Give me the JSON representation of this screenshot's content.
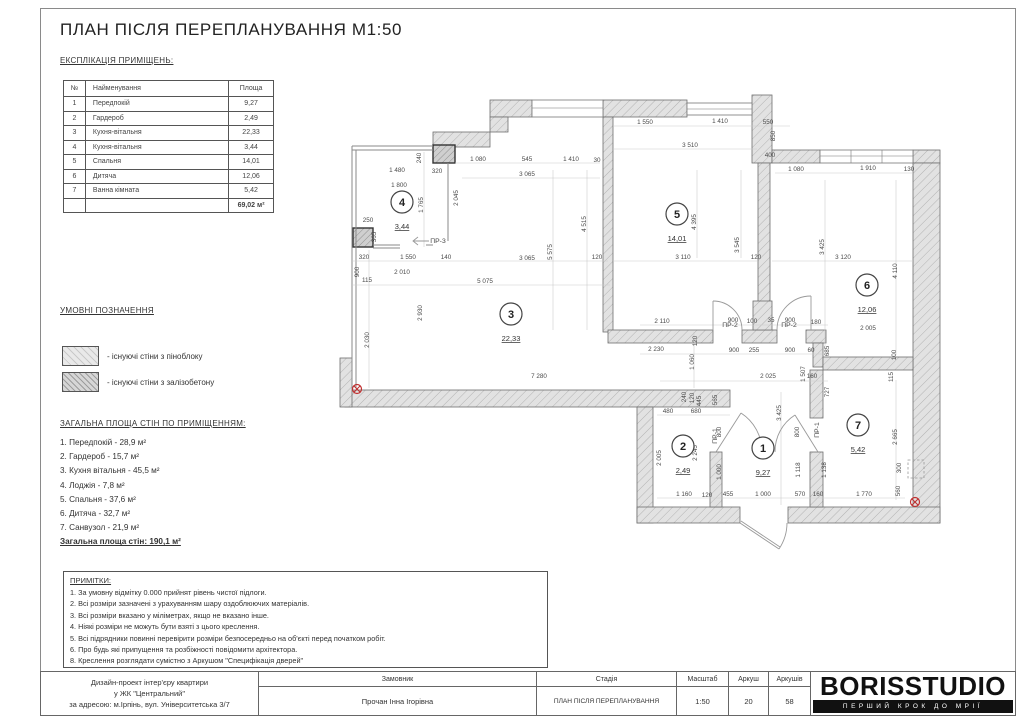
{
  "page": {
    "title": "ПЛАН ПІСЛЯ ПЕРЕПЛАНУВАННЯ М1:50"
  },
  "explication": {
    "heading": "ЕКСПЛІКАЦІЯ ПРИМІЩЕНЬ:",
    "columns": [
      "№",
      "Найменування",
      "Площа"
    ],
    "rows": [
      [
        "1",
        "Передпокій",
        "9,27"
      ],
      [
        "2",
        "Гардероб",
        "2,49"
      ],
      [
        "3",
        "Кухня-вітальня",
        "22,33"
      ],
      [
        "4",
        "Кухня-вітальня",
        "3,44"
      ],
      [
        "5",
        "Спальня",
        "14,01"
      ],
      [
        "6",
        "Дитяча",
        "12,06"
      ],
      [
        "7",
        "Ванна кімната",
        "5,42"
      ]
    ],
    "total": "69,02 м²"
  },
  "legend": {
    "heading": "УМОВНІ ПОЗНАЧЕННЯ",
    "items": [
      {
        "swatch": "foam-block",
        "label": "- існуючі стіни з піноблоку"
      },
      {
        "swatch": "reinforced-concrete",
        "label": "- існуючі стіни з залізобетону"
      }
    ]
  },
  "wall_areas": {
    "heading": "ЗАГАЛЬНА ПЛОЩА СТІН ПО ПРИМІЩЕННЯМ:",
    "items": [
      "1. Передпокій - 28,9 м²",
      "2. Гардероб - 15,7 м²",
      "3. Кухня вітальня - 45,5 м²",
      "4. Лоджія - 7,8 м²",
      "5. Спальня - 37,6 м²",
      "6. Дитяча - 32,7 м²",
      "7. Санвузол - 21,9 м²"
    ],
    "total": "Загальна площа стін: 190,1 м²"
  },
  "notes": {
    "heading": "ПРИМІТКИ:",
    "items": [
      "1. За умовну відмітку 0.000 прийнят рівень чистої підлоги.",
      "2. Всі розміри зазначені з урахуванням шару оздоблюючих матеріалів.",
      "3. Всі розміри вказано у міліметрах, якщо не вказано інше.",
      "4. Ніякі розміри не можуть бути взяті з цього креслення.",
      "5. Всі підрядники повинні перевірити розміри безпосередньо на об'єкті перед початком робіт.",
      "6. Про будь які припущення та розбіжності повідомити архітектора.",
      "8. Креслення розглядати сумістно з Аркушом \"Специфікація дверей\""
    ]
  },
  "titleblock": {
    "project_lines": [
      "Дизайн-проект інтер'єру квартири",
      "у ЖК \"Центральний\"",
      "за адресою: м.Ірпінь, вул. Університетська 3/7"
    ],
    "customer_label": "Замовник",
    "customer": "Прочан Інна Ігорівна",
    "stage_label": "Стадія",
    "stage": "ПЛАН ПІСЛЯ ПЕРЕПЛАНУВАННЯ",
    "scale_label": "Масштаб",
    "scale": "1:50",
    "sheet_label": "Аркуш",
    "sheet": "20",
    "sheets_label": "Аркушів",
    "sheets": "58",
    "logo": "BORISSTUDIO",
    "slogan": "ПЕРШИЙ КРОК ДО МРІЇ"
  },
  "plan": {
    "rooms": [
      {
        "num": "1",
        "area": "9,27",
        "cx": 763,
        "cy": 448
      },
      {
        "num": "2",
        "area": "2,49",
        "cx": 683,
        "cy": 446
      },
      {
        "num": "3",
        "area": "22,33",
        "cx": 511,
        "cy": 314
      },
      {
        "num": "4",
        "area": "3,44",
        "cx": 402,
        "cy": 202
      },
      {
        "num": "5",
        "area": "14,01",
        "cx": 677,
        "cy": 214
      },
      {
        "num": "6",
        "area": "12,06",
        "cx": 867,
        "cy": 285
      },
      {
        "num": "7",
        "area": "5,42",
        "cx": 858,
        "cy": 425
      }
    ],
    "door_labels": [
      {
        "t": "ПР-3",
        "x": 438,
        "y": 243
      },
      {
        "t": "ПР-2",
        "x": 730,
        "y": 327
      },
      {
        "t": "ПР-2",
        "x": 789,
        "y": 327
      },
      {
        "t": "ПР-1",
        "x": 717,
        "y": 436,
        "r": 1
      },
      {
        "t": "ПР-1",
        "x": 819,
        "y": 430,
        "r": 1
      }
    ],
    "red_marks": [
      {
        "x": 357,
        "y": 389
      },
      {
        "x": 915,
        "y": 502
      }
    ],
    "dimensions": [
      {
        "t": "240",
        "x": 421,
        "y": 158,
        "r": 1
      },
      {
        "t": "1 480",
        "x": 397,
        "y": 172
      },
      {
        "t": "320",
        "x": 437,
        "y": 173
      },
      {
        "t": "1 800",
        "x": 399,
        "y": 187
      },
      {
        "t": "1 765",
        "x": 423,
        "y": 205,
        "r": 1
      },
      {
        "t": "2 045",
        "x": 458,
        "y": 198,
        "r": 1
      },
      {
        "t": "250",
        "x": 368,
        "y": 222
      },
      {
        "t": "365",
        "x": 376,
        "y": 237,
        "r": 1
      },
      {
        "t": "320",
        "x": 364,
        "y": 259
      },
      {
        "t": "1 550",
        "x": 408,
        "y": 259
      },
      {
        "t": "140",
        "x": 446,
        "y": 259
      },
      {
        "t": "900",
        "x": 359,
        "y": 272,
        "r": 1
      },
      {
        "t": "2 010",
        "x": 402,
        "y": 274
      },
      {
        "t": "115",
        "x": 367,
        "y": 282
      },
      {
        "t": "5 075",
        "x": 485,
        "y": 283
      },
      {
        "t": "2 930",
        "x": 422,
        "y": 313,
        "r": 1
      },
      {
        "t": "2 030",
        "x": 369,
        "y": 340,
        "r": 1
      },
      {
        "t": "7 280",
        "x": 539,
        "y": 378
      },
      {
        "t": "1 080",
        "x": 478,
        "y": 161
      },
      {
        "t": "545",
        "x": 527,
        "y": 161
      },
      {
        "t": "1 410",
        "x": 571,
        "y": 161
      },
      {
        "t": "30",
        "x": 597,
        "y": 162
      },
      {
        "t": "3 065",
        "x": 527,
        "y": 176
      },
      {
        "t": "4 515",
        "x": 586,
        "y": 224,
        "r": 1
      },
      {
        "t": "5 575",
        "x": 552,
        "y": 252,
        "r": 1
      },
      {
        "t": "3 065",
        "x": 527,
        "y": 260
      },
      {
        "t": "120",
        "x": 597,
        "y": 259
      },
      {
        "t": "1 550",
        "x": 645,
        "y": 124
      },
      {
        "t": "1 410",
        "x": 720,
        "y": 123
      },
      {
        "t": "550",
        "x": 768,
        "y": 124
      },
      {
        "t": "3 510",
        "x": 690,
        "y": 147
      },
      {
        "t": "850",
        "x": 775,
        "y": 136,
        "r": 1
      },
      {
        "t": "400",
        "x": 770,
        "y": 157
      },
      {
        "t": "4 395",
        "x": 696,
        "y": 222,
        "r": 1
      },
      {
        "t": "3 545",
        "x": 739,
        "y": 245,
        "r": 1
      },
      {
        "t": "3 110",
        "x": 683,
        "y": 259
      },
      {
        "t": "120",
        "x": 756,
        "y": 259
      },
      {
        "t": "1 080",
        "x": 796,
        "y": 171
      },
      {
        "t": "1 910",
        "x": 868,
        "y": 170
      },
      {
        "t": "130",
        "x": 909,
        "y": 171
      },
      {
        "t": "3 425",
        "x": 824,
        "y": 247,
        "r": 1
      },
      {
        "t": "3 120",
        "x": 843,
        "y": 259
      },
      {
        "t": "4 110",
        "x": 897,
        "y": 271,
        "r": 1
      },
      {
        "t": "2 005",
        "x": 868,
        "y": 330
      },
      {
        "t": "2 110",
        "x": 662,
        "y": 323
      },
      {
        "t": "900",
        "x": 733,
        "y": 322
      },
      {
        "t": "100",
        "x": 752,
        "y": 323
      },
      {
        "t": "35",
        "x": 771,
        "y": 322
      },
      {
        "t": "900",
        "x": 790,
        "y": 322
      },
      {
        "t": "180",
        "x": 816,
        "y": 324
      },
      {
        "t": "2 230",
        "x": 656,
        "y": 351
      },
      {
        "t": "120",
        "x": 697,
        "y": 341,
        "r": 1
      },
      {
        "t": "1 060",
        "x": 694,
        "y": 362,
        "r": 1
      },
      {
        "t": "900",
        "x": 734,
        "y": 352
      },
      {
        "t": "255",
        "x": 754,
        "y": 352
      },
      {
        "t": "900",
        "x": 790,
        "y": 352
      },
      {
        "t": "60",
        "x": 811,
        "y": 352
      },
      {
        "t": "685",
        "x": 829,
        "y": 351,
        "r": 1
      },
      {
        "t": "100",
        "x": 896,
        "y": 355,
        "r": 1
      },
      {
        "t": "2 025",
        "x": 768,
        "y": 378
      },
      {
        "t": "1 507",
        "x": 805,
        "y": 374,
        "r": 1
      },
      {
        "t": "160",
        "x": 812,
        "y": 378
      },
      {
        "t": "115",
        "x": 893,
        "y": 377,
        "r": 1
      },
      {
        "t": "727",
        "x": 829,
        "y": 392,
        "r": 1
      },
      {
        "t": "240",
        "x": 686,
        "y": 397,
        "r": 1
      },
      {
        "t": "120",
        "x": 694,
        "y": 398,
        "r": 1
      },
      {
        "t": "445",
        "x": 701,
        "y": 401,
        "r": 1
      },
      {
        "t": "565",
        "x": 717,
        "y": 400,
        "r": 1
      },
      {
        "t": "480",
        "x": 668,
        "y": 413
      },
      {
        "t": "680",
        "x": 696,
        "y": 413
      },
      {
        "t": "800",
        "x": 721,
        "y": 432,
        "r": 1
      },
      {
        "t": "2 005",
        "x": 661,
        "y": 458,
        "r": 1
      },
      {
        "t": "2 245",
        "x": 697,
        "y": 453,
        "r": 1
      },
      {
        "t": "1 000",
        "x": 721,
        "y": 472,
        "r": 1
      },
      {
        "t": "3 425",
        "x": 781,
        "y": 413,
        "r": 1
      },
      {
        "t": "800",
        "x": 799,
        "y": 432,
        "r": 1
      },
      {
        "t": "1 118",
        "x": 800,
        "y": 470,
        "r": 1
      },
      {
        "t": "1 138",
        "x": 826,
        "y": 470,
        "r": 1
      },
      {
        "t": "2 665",
        "x": 897,
        "y": 437,
        "r": 1
      },
      {
        "t": "300",
        "x": 901,
        "y": 468,
        "r": 1
      },
      {
        "t": "560",
        "x": 900,
        "y": 491,
        "r": 1
      },
      {
        "t": "1 160",
        "x": 684,
        "y": 496
      },
      {
        "t": "120",
        "x": 707,
        "y": 497
      },
      {
        "t": "455",
        "x": 728,
        "y": 496
      },
      {
        "t": "1 000",
        "x": 763,
        "y": 496
      },
      {
        "t": "570",
        "x": 800,
        "y": 496
      },
      {
        "t": "160",
        "x": 818,
        "y": 496
      },
      {
        "t": "1 770",
        "x": 864,
        "y": 496
      }
    ]
  }
}
